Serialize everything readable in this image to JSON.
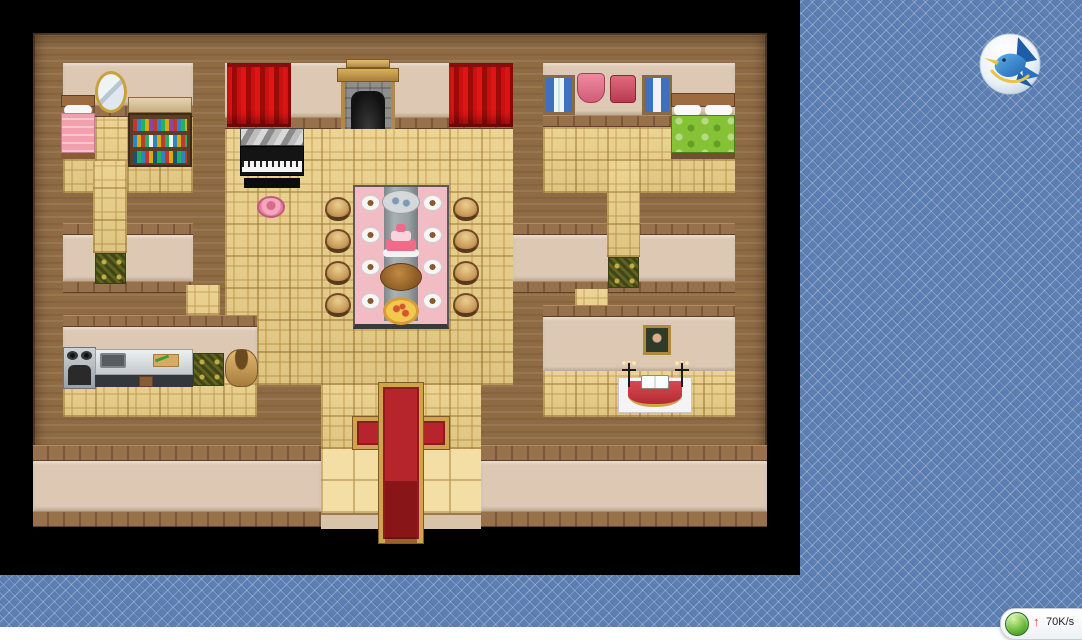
{
  "desktop": {
    "wallpaper": {
      "base_color": "#5b7eb3",
      "lattice_color": "#8aa4cf",
      "pattern": "diagonal-diamond-lattice"
    },
    "icons": [
      {
        "name": "hummingbird-app",
        "shape": "blue-hummingbird-on-white-disc"
      }
    ],
    "net_speed_widget": {
      "upload_arrow": "↑",
      "speed": "70K/s",
      "arrow_color": "#e2392c",
      "orb_color": "#4aa32f",
      "text_color": "#222222"
    }
  },
  "game_window": {
    "background": "#000000",
    "map": {
      "style": "rpg-maker-interior-mansion",
      "tile_size": 32,
      "palette": {
        "wall_wood": "#8f6b44",
        "floor_tile_gold": "#eacf88",
        "wall_panel_tan": "#dcc8b3",
        "brick_trim": "#8a6845",
        "carpet_red": "#b5252b",
        "carpet_border_gold": "#cfa44c",
        "curtain_red": "#cc1111",
        "bed_green": "#86c236",
        "bed_pink": "#f2a0ad",
        "table_cloth_pink": "#f2bcc4",
        "table_runner_gray": "#9aa2a6",
        "ornate_tile_green": "#5f6420"
      },
      "rooms": [
        {
          "name": "bedroom-west",
          "furniture": [
            "pink-single-bed",
            "gold-oval-mirror",
            "wooden-counter",
            "bookshelf-with-colored-books"
          ]
        },
        {
          "name": "stage-north",
          "furniture": [
            "red-stage-curtain-left",
            "stone-fireplace-with-mantel",
            "red-stage-curtain-right",
            "black-grand-piano",
            "pink-round-cushion"
          ]
        },
        {
          "name": "bedroom-east",
          "furniture": [
            "blue-curtained-window",
            "pink-dress-on-wall",
            "red-tunic-on-wall",
            "blue-curtained-window",
            "green-double-bed"
          ]
        },
        {
          "name": "banquet-hall-center",
          "furniture": [
            "long-banquet-table",
            "fish-platter",
            "tiered-pink-cake",
            "roast-turkey",
            "pizza",
            "eight-round-stools"
          ]
        },
        {
          "name": "kitchen-southwest",
          "furniture": [
            "gray-stove",
            "stainless-sink-counter",
            "cutting-board-with-leek",
            "grain-sack",
            "green-ornate-tile"
          ]
        },
        {
          "name": "study-southeast",
          "furniture": [
            "framed-portrait",
            "altar-table-with-red-cloth",
            "open-book",
            "candelabra-pair",
            "green-ornate-tile"
          ]
        },
        {
          "name": "entrance-south",
          "furniture": [
            "red-carpet-cross-with-gold-border",
            "porch-steps"
          ]
        }
      ]
    }
  }
}
